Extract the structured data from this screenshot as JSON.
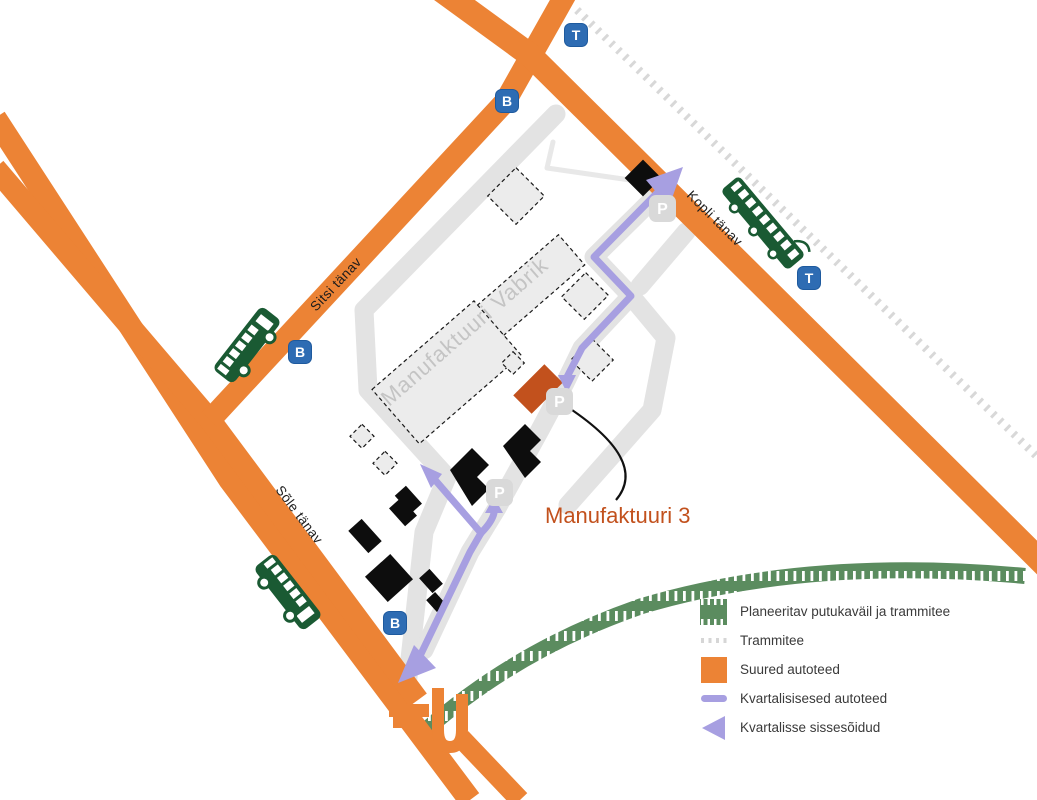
{
  "map": {
    "streets": {
      "sitsi": "Sitsi tänav",
      "sole": "Sõle tänav",
      "kopli": "Kopli tänav"
    },
    "area_label": "Manufaktuuri Vabrik",
    "highlight": {
      "label": "Manufaktuuri 3"
    },
    "badges": {
      "bus": "B",
      "tram": "T",
      "parking": "P"
    }
  },
  "legend": {
    "items": [
      {
        "key": "green-corridor",
        "label": "Planeeritav putukaväil ja trammitee"
      },
      {
        "key": "tramline",
        "label": "Trammitee"
      },
      {
        "key": "major-roads",
        "label": "Suured autoteed"
      },
      {
        "key": "quarter-roads",
        "label": "Kvartalisisesed autoteed"
      },
      {
        "key": "quarter-entrances",
        "label": "Kvartalisse sissesõidud"
      }
    ]
  },
  "colors": {
    "road_orange": "#EC8335",
    "route_purple": "#A79FE1",
    "badge_blue": "#2E6CB3",
    "green_corridor": "#5B8C5F",
    "tram_icon_green": "#1A5A33",
    "highlight_orange": "#C2511D",
    "minor_road_grey": "#E3E3E3",
    "parking_grey": "#D9D9D9",
    "tramline_grey": "#D8D8D8"
  }
}
